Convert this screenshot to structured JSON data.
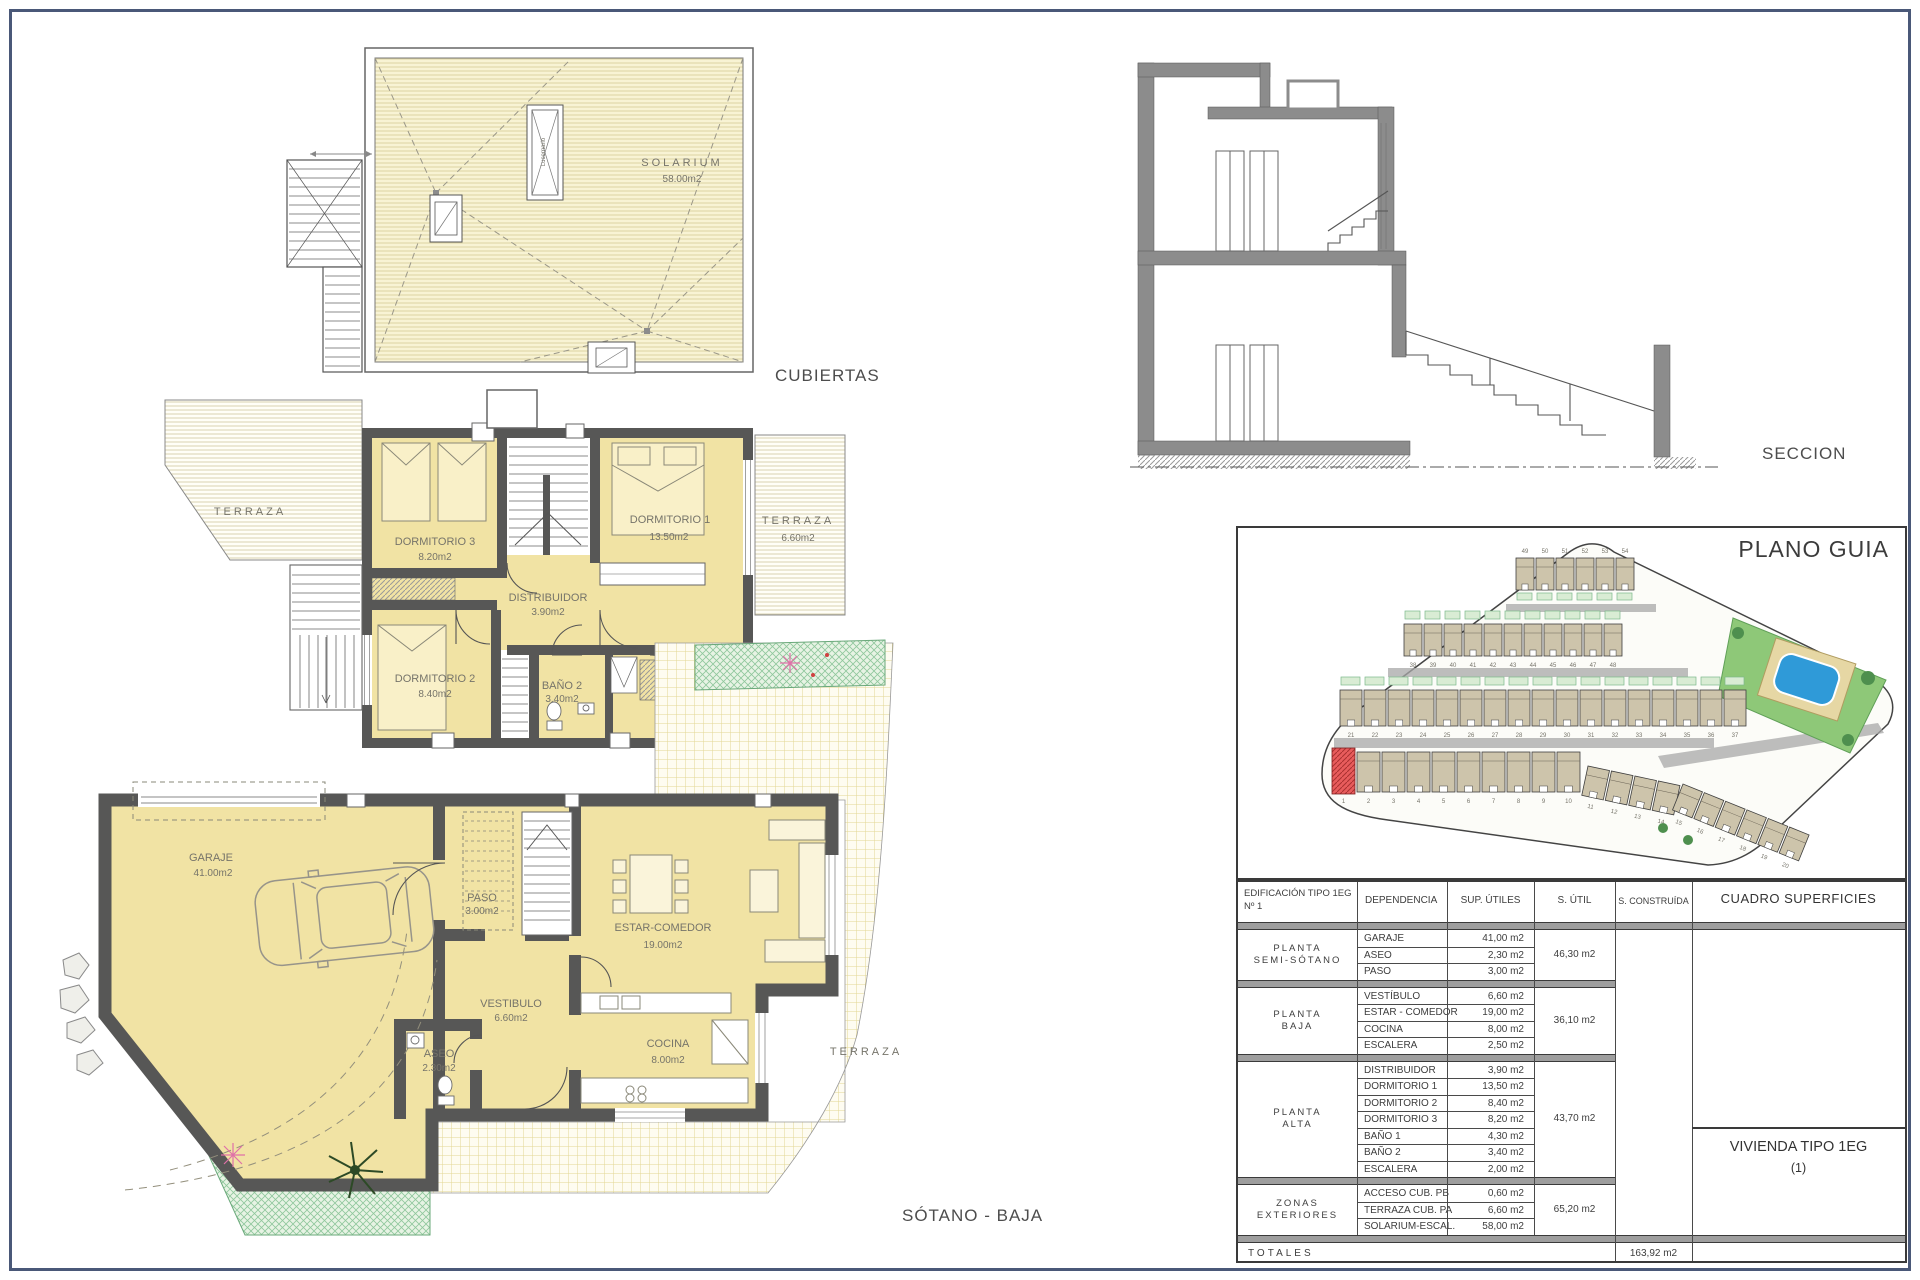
{
  "titles": {
    "cubiertas": "CUBIERTAS",
    "primera": "PRIMERA",
    "sotano_baja": "SÓTANO - BAJA",
    "seccion": "SECCION",
    "plano_guia": "PLANO GUIA"
  },
  "cubiertas": {
    "solarium_name": "SOLARIUM",
    "solarium_area": "58.00m2",
    "skylight_label": "Lucernario"
  },
  "primera": {
    "rooms": [
      {
        "name": "DORMITORIO 3",
        "area": "8.20m2"
      },
      {
        "name": "DORMITORIO 1",
        "area": "13.50m2"
      },
      {
        "name": "DISTRIBUIDOR",
        "area": "3.90m2"
      },
      {
        "name": "DORMITORIO 2",
        "area": "8.40m2"
      },
      {
        "name": "BAÑO 2",
        "area": "3.40m2"
      },
      {
        "name": "BAÑO 1",
        "area": "4.30m2"
      },
      {
        "name": "TERRAZA",
        "area": "6.60m2"
      },
      {
        "name": "TERRAZA",
        "area": ""
      }
    ]
  },
  "sotano": {
    "rooms": [
      {
        "name": "GARAJE",
        "area": "41.00m2"
      },
      {
        "name": "PASO",
        "area": "3.00m2"
      },
      {
        "name": "VESTIBULO",
        "area": "6.60m2"
      },
      {
        "name": "ASEO",
        "area": "2.30m2"
      },
      {
        "name": "ESTAR-COMEDOR",
        "area": "19.00m2"
      },
      {
        "name": "COCINA",
        "area": "8.00m2"
      },
      {
        "name": "TERRAZA",
        "area": ""
      }
    ]
  },
  "site": {
    "unit_rows": [
      {
        "numbers": [
          "49",
          "50",
          "51",
          "52",
          "53",
          "54"
        ]
      },
      {
        "numbers": [
          "38",
          "39",
          "40",
          "41",
          "42",
          "43",
          "44",
          "45",
          "46",
          "47",
          "48"
        ]
      },
      {
        "numbers": [
          "21",
          "22",
          "23",
          "24",
          "25",
          "26",
          "27",
          "28",
          "29",
          "30",
          "31",
          "32",
          "33",
          "34",
          "35",
          "36",
          "37"
        ]
      },
      {
        "numbers": [
          "1",
          "2",
          "3",
          "4",
          "5",
          "6",
          "7",
          "8",
          "9",
          "10"
        ]
      },
      {
        "numbers": [
          "11",
          "12",
          "13",
          "14"
        ]
      },
      {
        "numbers": [
          "15",
          "16",
          "17",
          "18",
          "19",
          "20"
        ]
      }
    ]
  },
  "table": {
    "header": {
      "col1_line1": "EDIFICACIÓN TIPO 1EG",
      "col1_line2": "Nº 1",
      "dependencia": "DEPENDENCIA",
      "sup_utiles": "SUP. ÚTILES",
      "s_util": "S. ÚTIL",
      "s_construida": "S. CONSTRUÍDA",
      "cuadro": "CUADRO SUPERFICIES"
    },
    "groups": [
      {
        "floor_lines": [
          "PLANTA",
          "SEMI-SÓTANO"
        ],
        "rows": [
          [
            "GARAJE",
            "41,00 m2"
          ],
          [
            "ASEO",
            "2,30 m2"
          ],
          [
            "PASO",
            "3,00 m2"
          ]
        ],
        "subtotal": "46,30 m2"
      },
      {
        "floor_lines": [
          "PLANTA",
          "BAJA"
        ],
        "rows": [
          [
            "VESTÍBULO",
            "6,60 m2"
          ],
          [
            "ESTAR - COMEDOR",
            "19,00 m2"
          ],
          [
            "COCINA",
            "8,00 m2"
          ],
          [
            "ESCALERA",
            "2,50 m2"
          ]
        ],
        "subtotal": "36,10 m2"
      },
      {
        "floor_lines": [
          "PLANTA",
          "ALTA"
        ],
        "rows": [
          [
            "DISTRIBUIDOR",
            "3,90 m2"
          ],
          [
            "DORMITORIO 1",
            "13,50 m2"
          ],
          [
            "DORMITORIO 2",
            "8,40 m2"
          ],
          [
            "DORMITORIO 3",
            "8,20 m2"
          ],
          [
            "BAÑO 1",
            "4,30 m2"
          ],
          [
            "BAÑO 2",
            "3,40 m2"
          ],
          [
            "ESCALERA",
            "2,00 m2"
          ]
        ],
        "subtotal": "43,70 m2"
      },
      {
        "floor_lines": [
          "ZONAS",
          "EXTERIORES"
        ],
        "rows": [
          [
            "ACCESO CUB. PB",
            "0,60 m2"
          ],
          [
            "TERRAZA CUB. PA",
            "6,60 m2"
          ],
          [
            "SOLARIUM-ESCAL.",
            "58,00 m2"
          ]
        ],
        "subtotal": "65,20 m2"
      }
    ],
    "totals": {
      "label": "TOTALES",
      "built": "163,92 m2"
    },
    "vivienda": {
      "line1": "VIVIENDA TIPO 1EG",
      "line2": "(1)"
    }
  },
  "colors": {
    "room_yellow": "#f1e3a4",
    "roof_cream": "#f8f3d4",
    "wall_gray": "#575756",
    "garden_green": "#8fc79c",
    "pool_blue": "#2f9ad8",
    "highlight_red": "#e85c5c",
    "frame_blue": "#4a5878"
  }
}
